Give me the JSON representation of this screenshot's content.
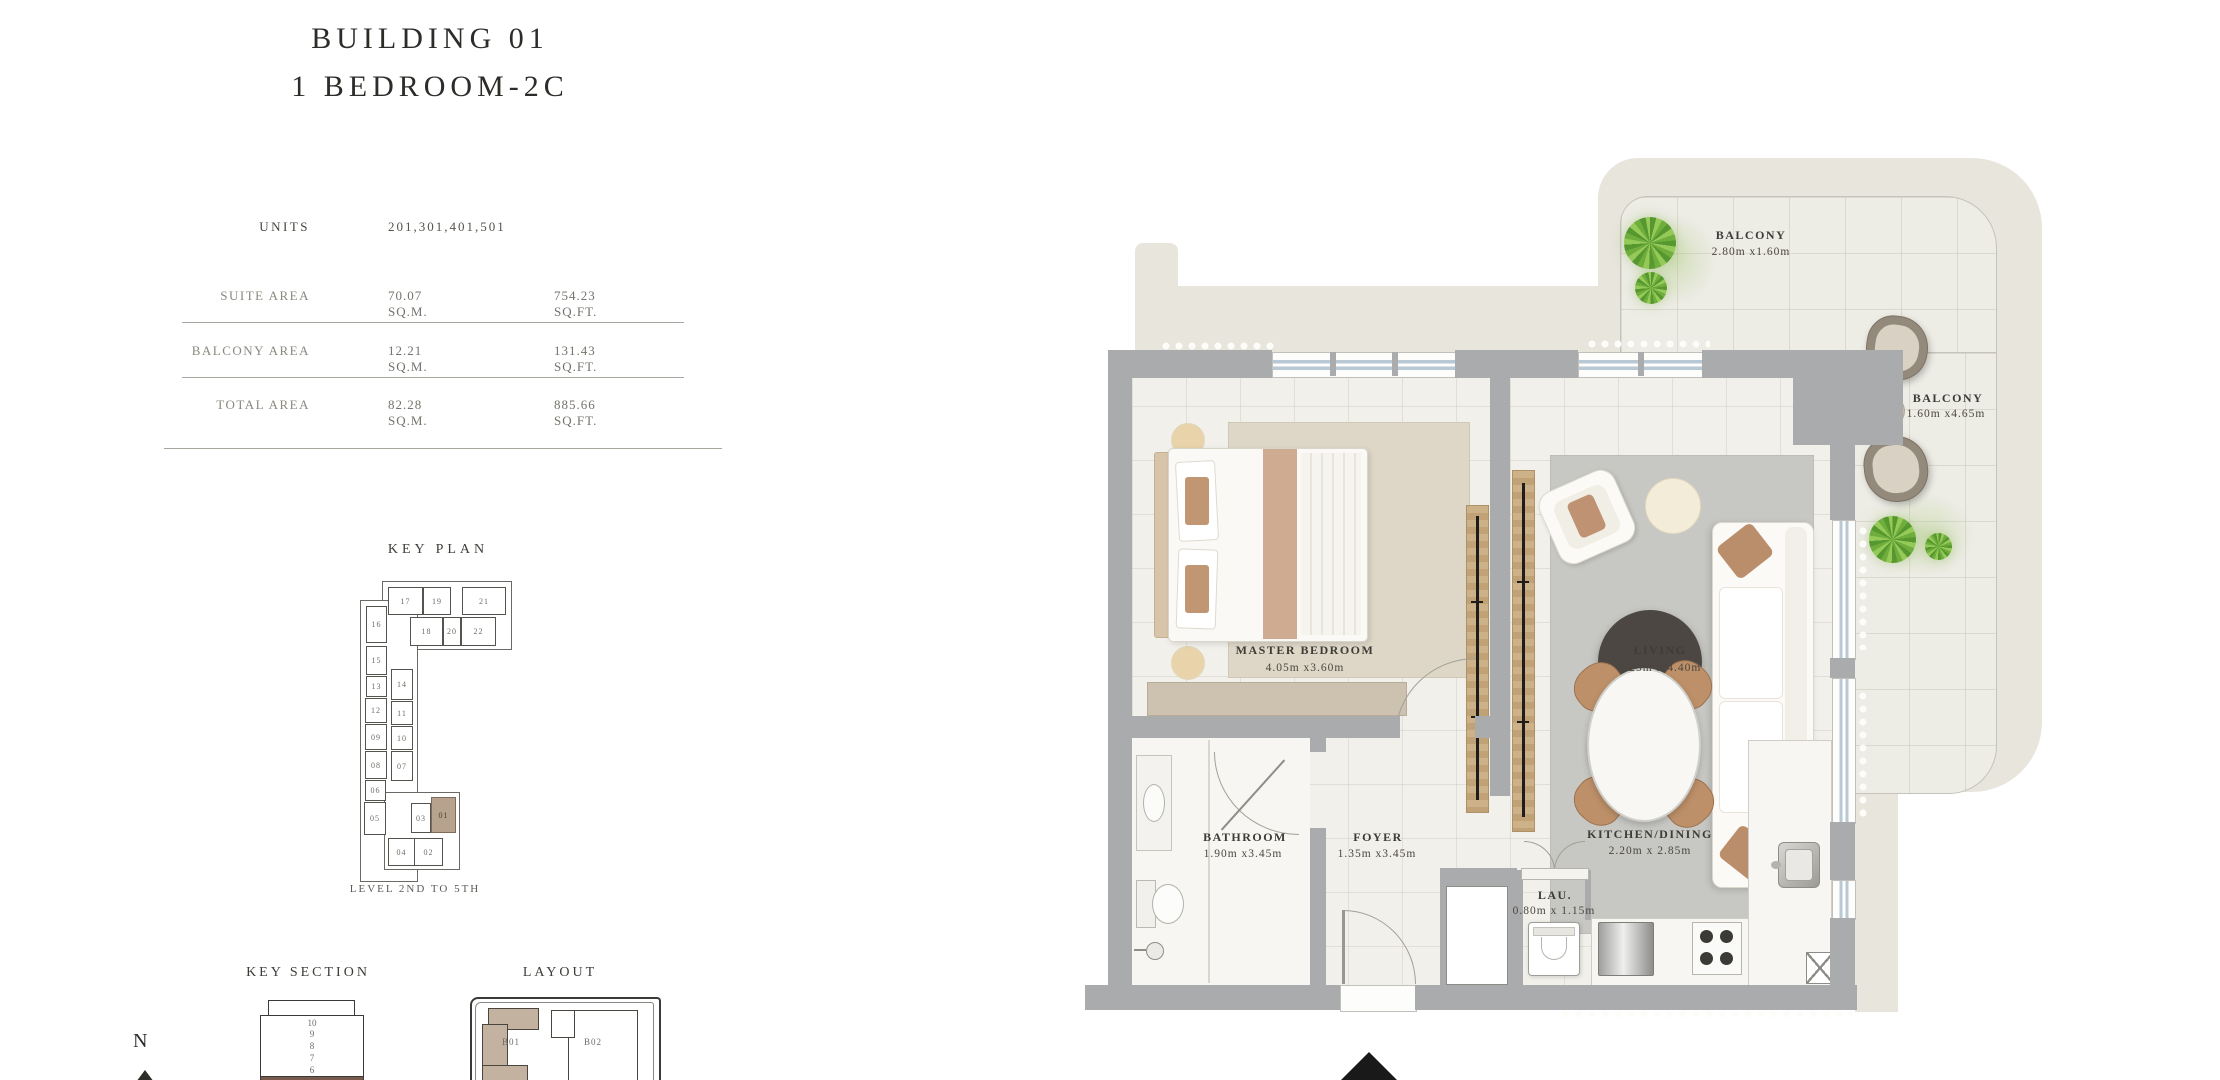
{
  "header": {
    "title_line1": "BUILDING 01",
    "title_line2": "1 BEDROOM-2C"
  },
  "info_table": {
    "units_label": "UNITS",
    "units_value": "201,301,401,501",
    "rows": [
      {
        "label": "SUITE AREA",
        "sqm": "70.07  SQ.M.",
        "sqft": "754.23  SQ.FT."
      },
      {
        "label": "BALCONY AREA",
        "sqm": "12.21  SQ.M.",
        "sqft": "131.43  SQ.FT."
      },
      {
        "label": "TOTAL AREA",
        "sqm": "82.28  SQ.M.",
        "sqft": "885.66  SQ.FT."
      }
    ]
  },
  "key_plan": {
    "title": "KEY PLAN",
    "level_label": "LEVEL 2ND TO 5TH",
    "highlighted_unit": "01",
    "units": [
      "17",
      "19",
      "21",
      "18",
      "20",
      "22",
      "16",
      "15",
      "13",
      "12",
      "09",
      "08",
      "06",
      "05",
      "14",
      "11",
      "10",
      "07",
      "03",
      "01",
      "04",
      "02"
    ]
  },
  "key_section": {
    "title": "KEY SECTION",
    "floors": [
      "10",
      "9",
      "8",
      "7",
      "6"
    ]
  },
  "layout": {
    "title": "LAYOUT",
    "buildings": [
      "B01",
      "B02"
    ]
  },
  "compass": {
    "label": "N"
  },
  "floor_plan": {
    "rooms": [
      {
        "name": "BALCONY",
        "dims": "2.80m x1.60m"
      },
      {
        "name": "BALCONY",
        "dims": "1.60m x4.65m"
      },
      {
        "name": "MASTER BEDROOM",
        "dims": "4.05m x3.60m"
      },
      {
        "name": "LIVING",
        "dims": "4.25m x 4.40m"
      },
      {
        "name": "BATHROOM",
        "dims": "1.90m x3.45m"
      },
      {
        "name": "FOYER",
        "dims": "1.35m x3.45m"
      },
      {
        "name": "KITCHEN/DINING",
        "dims": "2.20m x 2.85m"
      },
      {
        "name": "LAU.",
        "dims": "0.80m x 1.15m"
      }
    ]
  },
  "colors": {
    "wall_gray": "#a9abac",
    "beige_band": "#e7e5dc",
    "highlight_tan": "#b7a38d",
    "accent_brown": "#bd9069",
    "section_highlight": "#7a5a4e"
  }
}
